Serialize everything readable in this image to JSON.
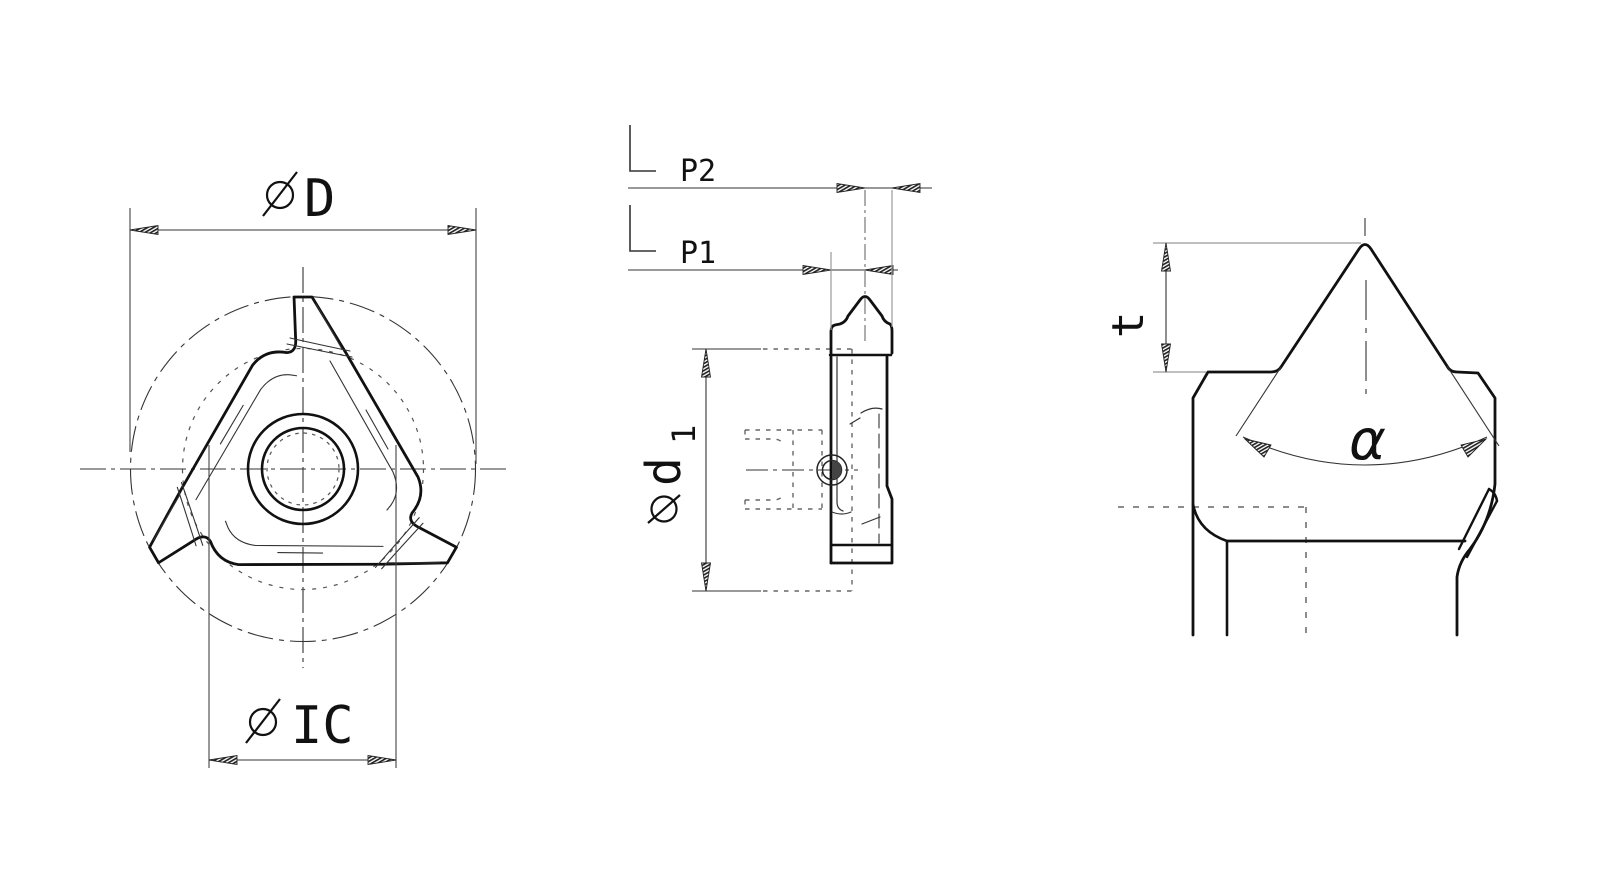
{
  "drawing": {
    "background": "#ffffff",
    "colors": {
      "outline": "#111111",
      "thin_line": "#333333",
      "hidden_line": "#666666",
      "extension_gray": "#999999"
    },
    "views": {
      "front": {
        "labels": {
          "outer_diameter_letter": "D",
          "inscribed_circle_letters": "IC"
        }
      },
      "side": {
        "labels": {
          "pitch_p2": "P2",
          "pitch_p1": "P1",
          "hole_diameter_letter": "d",
          "hole_diameter_subscript": "1"
        }
      },
      "tip_detail": {
        "labels": {
          "flank_angle": "α",
          "tooth_depth": "t"
        }
      }
    },
    "symbols": {
      "diameter_symbol": "ø",
      "reference_corner_symbol": "∟"
    }
  }
}
